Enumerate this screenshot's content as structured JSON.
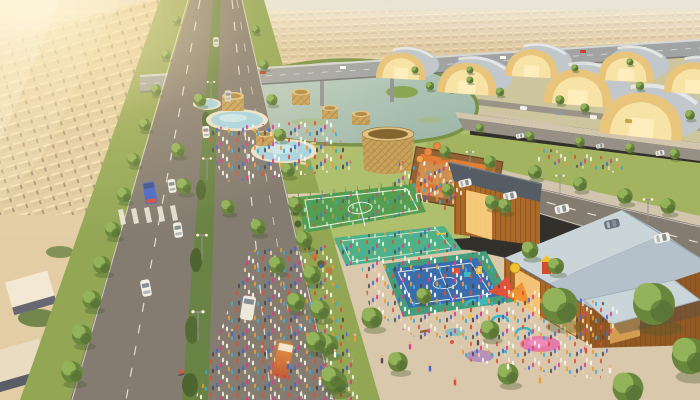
{
  "scene": {
    "type": "aerial-3d-render",
    "time_of_day": "golden-hour",
    "regions": {
      "upper_left": "sunlit-suburban-rows",
      "left": "tree-lined-divided-avenue-with-traffic",
      "top_center": "elevated-highway-and-distant-suburbs",
      "center_top": "lake-with-reed-edges",
      "center": "community-park-with-pools-pavilions-and-crowds",
      "center_right": "giant-wicker-basket-pavilion-and-open-air-food-court",
      "upper_right": "rows-of-barrel-vaulted-golden-halls",
      "mid_right": "timber-halls-with-pitched-roofs",
      "lower_center": "soccer-field-teal-court-and-blue-basketball-court",
      "lower_right": "colorful-playground-and-plaza-crowds"
    },
    "palette": {
      "sky_top": "#e6e5de",
      "sky_horizon": "#f7efd2",
      "sun_glow": "#fff8dd",
      "far_suburbs": "#dcc9a6",
      "left_suburbs": "#e0cda6",
      "suburb_roof_lit": "#f2ead8",
      "suburb_wall_shadow": "#596070",
      "overpass": "#9aa0a4",
      "water": "#a9c4ba",
      "reeds": "#6e8c3f",
      "lawn": "#a8bd6b",
      "road": "#7a746e",
      "median_green": "#5d7c3e",
      "lane_marking": "#f2f0ea",
      "grass_verge": "#89a24f",
      "plaza": "#d7c7ae",
      "pool_water": "#9fd4e8",
      "pool_deck": "#ece4cf",
      "soccer_green": "#459a4b",
      "court_teal": "#3fae86",
      "court_blue": "#2a64ad",
      "court_border": "#35997a",
      "hedge": "#3f5c28",
      "wicker": "#c59f56",
      "food_court_wall": "#8a5a2e",
      "food_court_floor": "#c98a4a",
      "awning_orange": "#e0762e",
      "timber_wall": "#a5611f",
      "timber_glow": "#ffd382",
      "roof_dark": "#47525f",
      "roof_light": "#aebfd0",
      "roof_highlight": "#c6d5e0",
      "hall_roof": "#bcc6cf",
      "hall_front": "#e6c478",
      "tree_mid": "#5c8136",
      "playground_pink": "#e558a8",
      "playground_red": "#e04632",
      "playground_orange": "#f08c28",
      "playground_teal": "#2fb5c5",
      "playground_purple": "#8a5ac9",
      "car_white": "#f2f1ec",
      "truck_blue": "#3a5fc9",
      "truck_orange": "#d97a2e"
    }
  }
}
